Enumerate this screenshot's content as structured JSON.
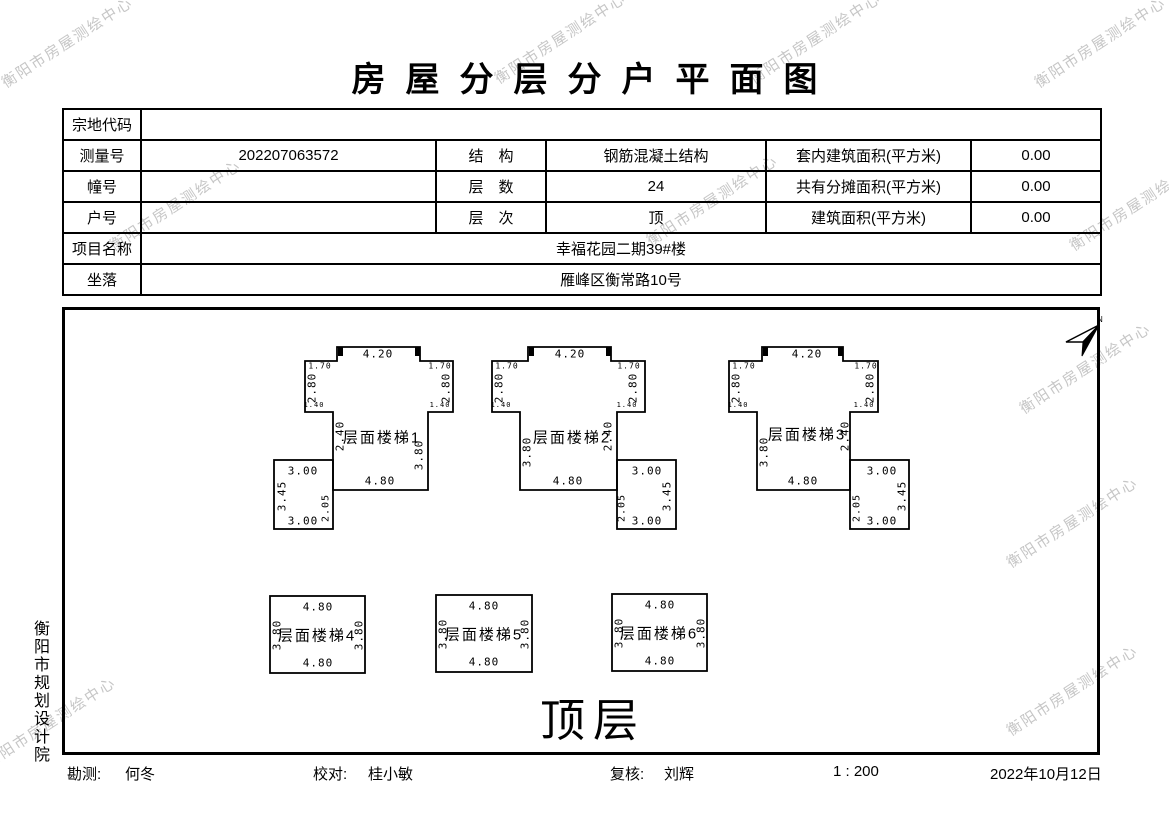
{
  "title": "房屋分层分户平面图",
  "watermark": {
    "text": "衡阳市房屋测绘中心",
    "color": "#c6c6c6",
    "angle": -33,
    "positions": [
      [
        67,
        42
      ],
      [
        560,
        38
      ],
      [
        815,
        38
      ],
      [
        1100,
        42
      ],
      [
        175,
        205
      ],
      [
        712,
        200
      ],
      [
        1135,
        205
      ],
      [
        1085,
        368
      ],
      [
        1072,
        522
      ],
      [
        1072,
        690
      ],
      [
        50,
        722
      ]
    ]
  },
  "info": {
    "parcel_code_label": "宗地代码",
    "parcel_code": "",
    "survey_no_label": "测量号",
    "survey_no": "202207063572",
    "structure_label": "结　构",
    "structure": "钢筋混凝土结构",
    "indoor_area_label": "套内建筑面积(平方米)",
    "indoor_area": "0.00",
    "building_no_label": "幢号",
    "building_no": "",
    "floors_label": "层　数",
    "floors": "24",
    "shared_area_label": "共有分摊面积(平方米)",
    "shared_area": "0.00",
    "unit_no_label": "户号",
    "unit_no": "",
    "level_label": "层　次",
    "level": "顶",
    "area_label": "建筑面积(平方米)",
    "area": "0.00",
    "project_label": "项目名称",
    "project": "幸福花园二期39#楼",
    "location_label": "坐落",
    "location": "雁峰区衡常路10号"
  },
  "drawing": {
    "floor_label": "顶层",
    "north_label": "N",
    "units": [
      {
        "name": "层面楼梯1",
        "polygon": "305,361 337,361 337,347 420,347 420,361 453,361 453,412 428,412 428,490 333,490 333,412 305,412",
        "rect": [
          274,
          460,
          59,
          69
        ],
        "tabs": [
          [
            338,
            347
          ],
          [
            415,
            347
          ]
        ],
        "labels": [
          {
            "t": "4.20",
            "x": 378,
            "y": 354,
            "s": 11
          },
          {
            "t": "1.70",
            "x": 320,
            "y": 366,
            "s": 8
          },
          {
            "t": "1.70",
            "x": 440,
            "y": 366,
            "s": 8
          },
          {
            "t": "2.80",
            "x": 312,
            "y": 388,
            "r": -90,
            "s": 11
          },
          {
            "t": "2.80",
            "x": 446,
            "y": 388,
            "r": -90,
            "s": 11
          },
          {
            "t": "1.40",
            "x": 314,
            "y": 405,
            "s": 7
          },
          {
            "t": "1.40",
            "x": 440,
            "y": 405,
            "s": 7
          },
          {
            "t": "2.40",
            "x": 340,
            "y": 436,
            "r": -90,
            "s": 11
          },
          {
            "t": "层面楼梯1",
            "x": 382,
            "y": 437,
            "s": 15,
            "c": "name"
          },
          {
            "t": "3.80",
            "x": 419,
            "y": 455,
            "r": -90,
            "s": 11
          },
          {
            "t": "3.00",
            "x": 303,
            "y": 471,
            "s": 11
          },
          {
            "t": "3.45",
            "x": 282,
            "y": 496,
            "r": -90,
            "s": 11
          },
          {
            "t": "2.05",
            "x": 326,
            "y": 508,
            "r": -90,
            "s": 10
          },
          {
            "t": "3.00",
            "x": 303,
            "y": 521,
            "s": 11
          },
          {
            "t": "4.80",
            "x": 380,
            "y": 481,
            "s": 11
          }
        ]
      },
      {
        "name": "层面楼梯2",
        "polygon": "492,361 528,361 528,347 611,347 611,361 645,361 645,412 617,412 617,490 520,490 520,412 492,412",
        "rect": [
          617,
          460,
          59,
          69
        ],
        "tabs": [
          [
            529,
            347
          ],
          [
            606,
            347
          ]
        ],
        "labels": [
          {
            "t": "4.20",
            "x": 570,
            "y": 354,
            "s": 11
          },
          {
            "t": "1.70",
            "x": 507,
            "y": 366,
            "s": 8
          },
          {
            "t": "1.70",
            "x": 629,
            "y": 366,
            "s": 8
          },
          {
            "t": "2.80",
            "x": 499,
            "y": 388,
            "r": -90,
            "s": 11
          },
          {
            "t": "2.80",
            "x": 633,
            "y": 388,
            "r": -90,
            "s": 11
          },
          {
            "t": "1.40",
            "x": 501,
            "y": 405,
            "s": 7
          },
          {
            "t": "1.40",
            "x": 627,
            "y": 405,
            "s": 7
          },
          {
            "t": "3.80",
            "x": 527,
            "y": 452,
            "r": -90,
            "s": 11
          },
          {
            "t": "层面楼梯2",
            "x": 572,
            "y": 437,
            "s": 15,
            "c": "name"
          },
          {
            "t": "2.40",
            "x": 608,
            "y": 436,
            "r": -90,
            "s": 11
          },
          {
            "t": "3.00",
            "x": 647,
            "y": 471,
            "s": 11
          },
          {
            "t": "3.45",
            "x": 667,
            "y": 496,
            "r": -90,
            "s": 11
          },
          {
            "t": "2.05",
            "x": 622,
            "y": 508,
            "r": -90,
            "s": 10
          },
          {
            "t": "3.00",
            "x": 647,
            "y": 521,
            "s": 11
          },
          {
            "t": "4.80",
            "x": 568,
            "y": 481,
            "s": 11
          }
        ]
      },
      {
        "name": "层面楼梯3",
        "polygon": "729,361 762,361 762,347 843,347 843,361 878,361 878,412 850,412 850,490 757,490 757,412 729,412",
        "rect": [
          850,
          460,
          59,
          69
        ],
        "tabs": [
          [
            763,
            347
          ],
          [
            838,
            347
          ]
        ],
        "labels": [
          {
            "t": "4.20",
            "x": 807,
            "y": 354,
            "s": 11
          },
          {
            "t": "1.70",
            "x": 744,
            "y": 366,
            "s": 8
          },
          {
            "t": "1.70",
            "x": 866,
            "y": 366,
            "s": 8
          },
          {
            "t": "2.80",
            "x": 736,
            "y": 388,
            "r": -90,
            "s": 11
          },
          {
            "t": "2.80",
            "x": 870,
            "y": 388,
            "r": -90,
            "s": 11
          },
          {
            "t": "1.40",
            "x": 738,
            "y": 405,
            "s": 7
          },
          {
            "t": "1.40",
            "x": 864,
            "y": 405,
            "s": 7
          },
          {
            "t": "3.80",
            "x": 764,
            "y": 452,
            "r": -90,
            "s": 11
          },
          {
            "t": "层面楼梯3",
            "x": 807,
            "y": 434,
            "s": 15,
            "c": "name"
          },
          {
            "t": "2.40",
            "x": 845,
            "y": 436,
            "r": -90,
            "s": 11
          },
          {
            "t": "3.00",
            "x": 882,
            "y": 471,
            "s": 11
          },
          {
            "t": "3.45",
            "x": 902,
            "y": 496,
            "r": -90,
            "s": 11
          },
          {
            "t": "2.05",
            "x": 857,
            "y": 508,
            "r": -90,
            "s": 10
          },
          {
            "t": "3.00",
            "x": 882,
            "y": 521,
            "s": 11
          },
          {
            "t": "4.80",
            "x": 803,
            "y": 481,
            "s": 11
          }
        ]
      },
      {
        "name": "层面楼梯4",
        "rect": [
          270,
          596,
          95,
          77
        ],
        "labels": [
          {
            "t": "4.80",
            "x": 318,
            "y": 607,
            "s": 11
          },
          {
            "t": "3.80",
            "x": 277,
            "y": 635,
            "r": -90,
            "s": 11
          },
          {
            "t": "层面楼梯4",
            "x": 317,
            "y": 635,
            "s": 15,
            "c": "name"
          },
          {
            "t": "3.80",
            "x": 359,
            "y": 635,
            "r": -90,
            "s": 11
          },
          {
            "t": "4.80",
            "x": 318,
            "y": 663,
            "s": 11
          }
        ]
      },
      {
        "name": "层面楼梯5",
        "rect": [
          436,
          595,
          96,
          77
        ],
        "labels": [
          {
            "t": "4.80",
            "x": 484,
            "y": 606,
            "s": 11
          },
          {
            "t": "3.80",
            "x": 443,
            "y": 634,
            "r": -90,
            "s": 11
          },
          {
            "t": "层面楼梯5",
            "x": 484,
            "y": 634,
            "s": 15,
            "c": "name"
          },
          {
            "t": "3.80",
            "x": 525,
            "y": 634,
            "r": -90,
            "s": 11
          },
          {
            "t": "4.80",
            "x": 484,
            "y": 662,
            "s": 11
          }
        ]
      },
      {
        "name": "层面楼梯6",
        "rect": [
          612,
          594,
          95,
          77
        ],
        "labels": [
          {
            "t": "4.80",
            "x": 660,
            "y": 605,
            "s": 11
          },
          {
            "t": "3.80",
            "x": 619,
            "y": 633,
            "r": -90,
            "s": 11
          },
          {
            "t": "层面楼梯6",
            "x": 659,
            "y": 633,
            "s": 15,
            "c": "name"
          },
          {
            "t": "3.80",
            "x": 701,
            "y": 633,
            "r": -90,
            "s": 11
          },
          {
            "t": "4.80",
            "x": 660,
            "y": 661,
            "s": 11
          }
        ]
      }
    ]
  },
  "side_label": "衡阳市规划设计院",
  "footer": {
    "surveyor_label": "勘测:",
    "surveyor": "何冬",
    "checker_label": "校对:",
    "checker": "桂小敏",
    "reviewer_label": "复核:",
    "reviewer": "刘辉",
    "scale": "1 : 200",
    "date": "2022年10月12日"
  }
}
